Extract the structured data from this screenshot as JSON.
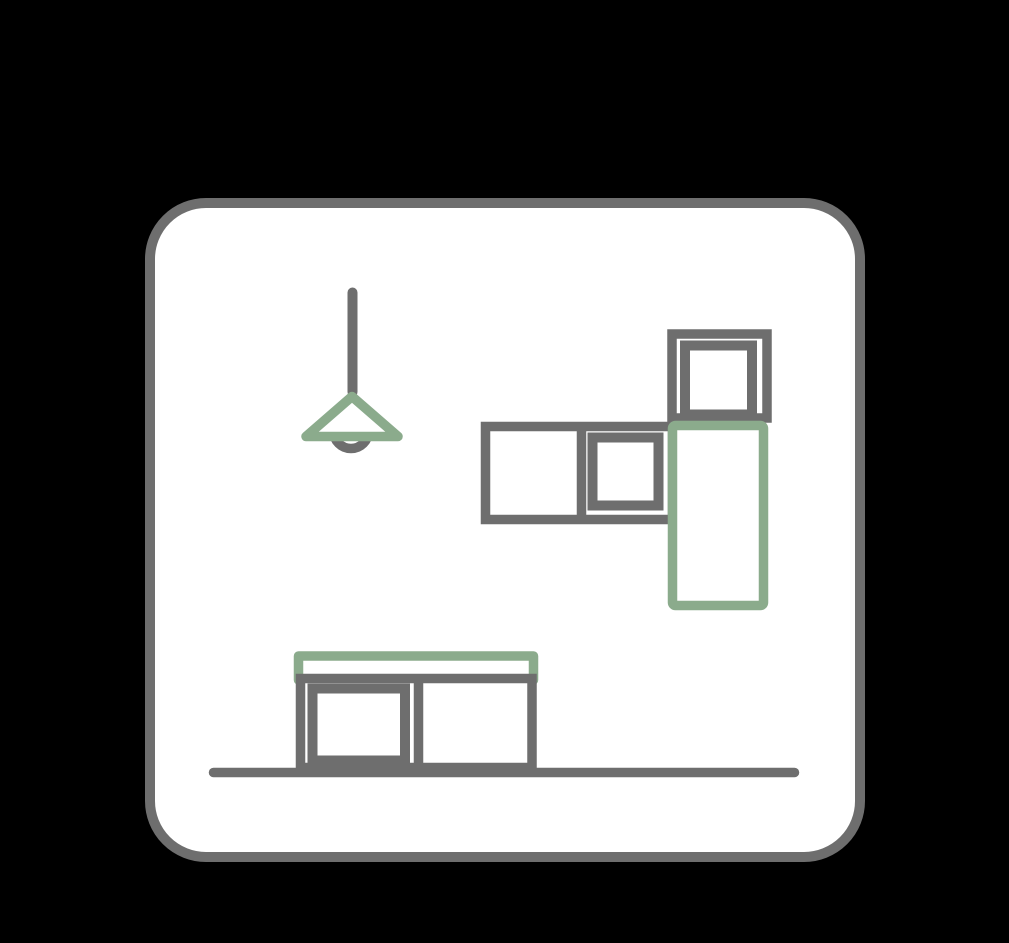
{
  "scene": {
    "name": "kitchen-furniture-line-icon",
    "background_color": "#000000",
    "card": {
      "shape": "rounded-square",
      "fill_color": "#ffffff",
      "border_color": "#6e6e6e"
    },
    "palette": {
      "outline_gray": "#6e6e6e",
      "accent_green": "#8bab8c",
      "surface_white": "#ffffff",
      "backdrop_black": "#000000"
    },
    "elements": {
      "pendant_lamp": {
        "parts": [
          "cord",
          "conical-shade",
          "bulb-arc"
        ],
        "cord_color": "#6e6e6e",
        "shade_color": "#8bab8c",
        "bulb_color": "#6e6e6e"
      },
      "wall_cabinet_row": {
        "sections": 2,
        "door_panels": 1,
        "color": "#6e6e6e"
      },
      "upper_cabinet": {
        "door_panels": 1,
        "color": "#6e6e6e"
      },
      "tall_cabinet": {
        "color": "#8bab8c"
      },
      "sideboard": {
        "countertop_color": "#8bab8c",
        "body_color": "#6e6e6e",
        "sections": 2,
        "door_panels": 1
      },
      "floor_line": {
        "color": "#6e6e6e"
      }
    }
  }
}
